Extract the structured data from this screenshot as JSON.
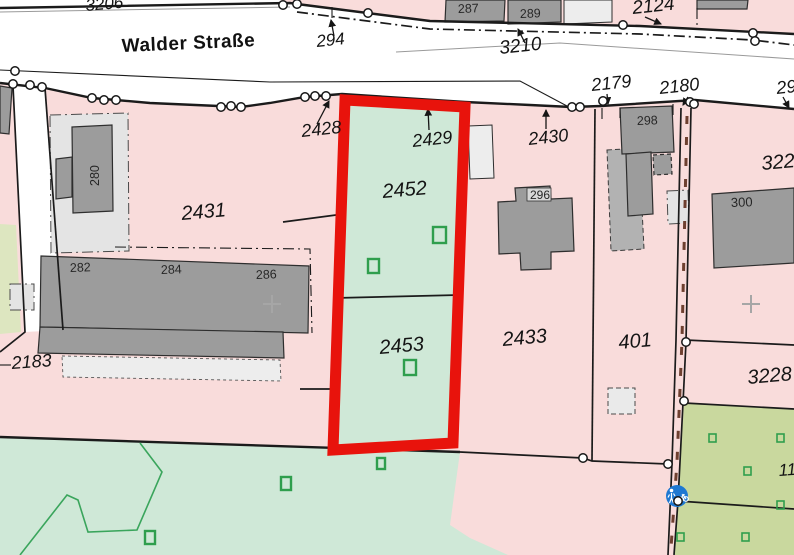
{
  "map": {
    "street_name": "Walder Straße",
    "colors": {
      "pink": "#f9dcdb",
      "green": "#cfe8d7",
      "olive": "#c9d89e",
      "olive_light": "#dde6c0",
      "bld_dark": "#9c9c9c",
      "bld_mid": "#b2b2b2",
      "bld_light": "#ededed",
      "zone": "#e4e4e4",
      "red": "#e8130c",
      "blue": "#1e78d2",
      "sym_green": "#2f9e4d",
      "veg_green": "#3aa55c",
      "ink": "#1b1b1b",
      "label": "#141414",
      "bld_label": "#262626",
      "brown": "#6e4030",
      "cross": "#a6a6a6"
    },
    "highlighted_parcels": [
      "2452",
      "2453"
    ],
    "parcel_labels": [
      {
        "text": "3206",
        "x": 86,
        "y": 11,
        "fs": 17,
        "rot": -5
      },
      {
        "text": "294",
        "x": 317,
        "y": 47,
        "fs": 17,
        "rot": -6
      },
      {
        "text": "3210",
        "x": 500,
        "y": 54,
        "fs": 19,
        "rot": -6
      },
      {
        "text": "2124",
        "x": 633,
        "y": 14,
        "fs": 19,
        "rot": -6
      },
      {
        "text": "2179",
        "x": 592,
        "y": 91,
        "fs": 18,
        "rot": -6
      },
      {
        "text": "2180",
        "x": 660,
        "y": 94,
        "fs": 18,
        "rot": -6
      },
      {
        "text": "29",
        "x": 777,
        "y": 94,
        "fs": 18,
        "rot": -6
      },
      {
        "text": "2428",
        "x": 302,
        "y": 137,
        "fs": 18,
        "rot": -6
      },
      {
        "text": "2429",
        "x": 413,
        "y": 147,
        "fs": 18,
        "rot": -6
      },
      {
        "text": "2430",
        "x": 529,
        "y": 145,
        "fs": 18,
        "rot": -6
      },
      {
        "text": "2431",
        "x": 182,
        "y": 220,
        "fs": 20,
        "rot": -5
      },
      {
        "text": "2452",
        "x": 383,
        "y": 198,
        "fs": 20,
        "rot": -5
      },
      {
        "text": "322",
        "x": 762,
        "y": 170,
        "fs": 20,
        "rot": -5
      },
      {
        "text": "2183",
        "x": 12,
        "y": 369,
        "fs": 18,
        "rot": -4
      },
      {
        "text": "2453",
        "x": 380,
        "y": 354,
        "fs": 20,
        "rot": -5
      },
      {
        "text": "2433",
        "x": 503,
        "y": 346,
        "fs": 20,
        "rot": -5
      },
      {
        "text": "401",
        "x": 619,
        "y": 349,
        "fs": 20,
        "rot": -5
      },
      {
        "text": "3228",
        "x": 748,
        "y": 384,
        "fs": 20,
        "rot": -5
      },
      {
        "text": "11",
        "x": 779,
        "y": 476,
        "fs": 17,
        "rot": -4
      }
    ],
    "building_labels": [
      {
        "text": "287",
        "x": 458,
        "y": 13,
        "fs": 12.5,
        "rot": -2
      },
      {
        "text": "289",
        "x": 520,
        "y": 18,
        "fs": 12.5,
        "rot": -2
      },
      {
        "text": "280",
        "x": 99,
        "y": 186,
        "fs": 12.5,
        "rot": -90
      },
      {
        "text": "282",
        "x": 70,
        "y": 272,
        "fs": 12.5,
        "rot": -2
      },
      {
        "text": "284",
        "x": 161,
        "y": 274,
        "fs": 12.5,
        "rot": -2
      },
      {
        "text": "286",
        "x": 256,
        "y": 279,
        "fs": 12.5,
        "rot": -2
      },
      {
        "text": "296",
        "x": 530,
        "y": 199,
        "fs": 12,
        "rot": 0
      },
      {
        "text": "298",
        "x": 637,
        "y": 125,
        "fs": 12.5,
        "rot": -2
      },
      {
        "text": "300",
        "x": 731,
        "y": 207,
        "fs": 13,
        "rot": -2
      }
    ],
    "icons": {
      "pedestrian_bike_sign": "blue circle, white pedestrian and bicycle",
      "survey_point": "white circle with black outline",
      "grid_cross": "gray plus mark"
    }
  }
}
